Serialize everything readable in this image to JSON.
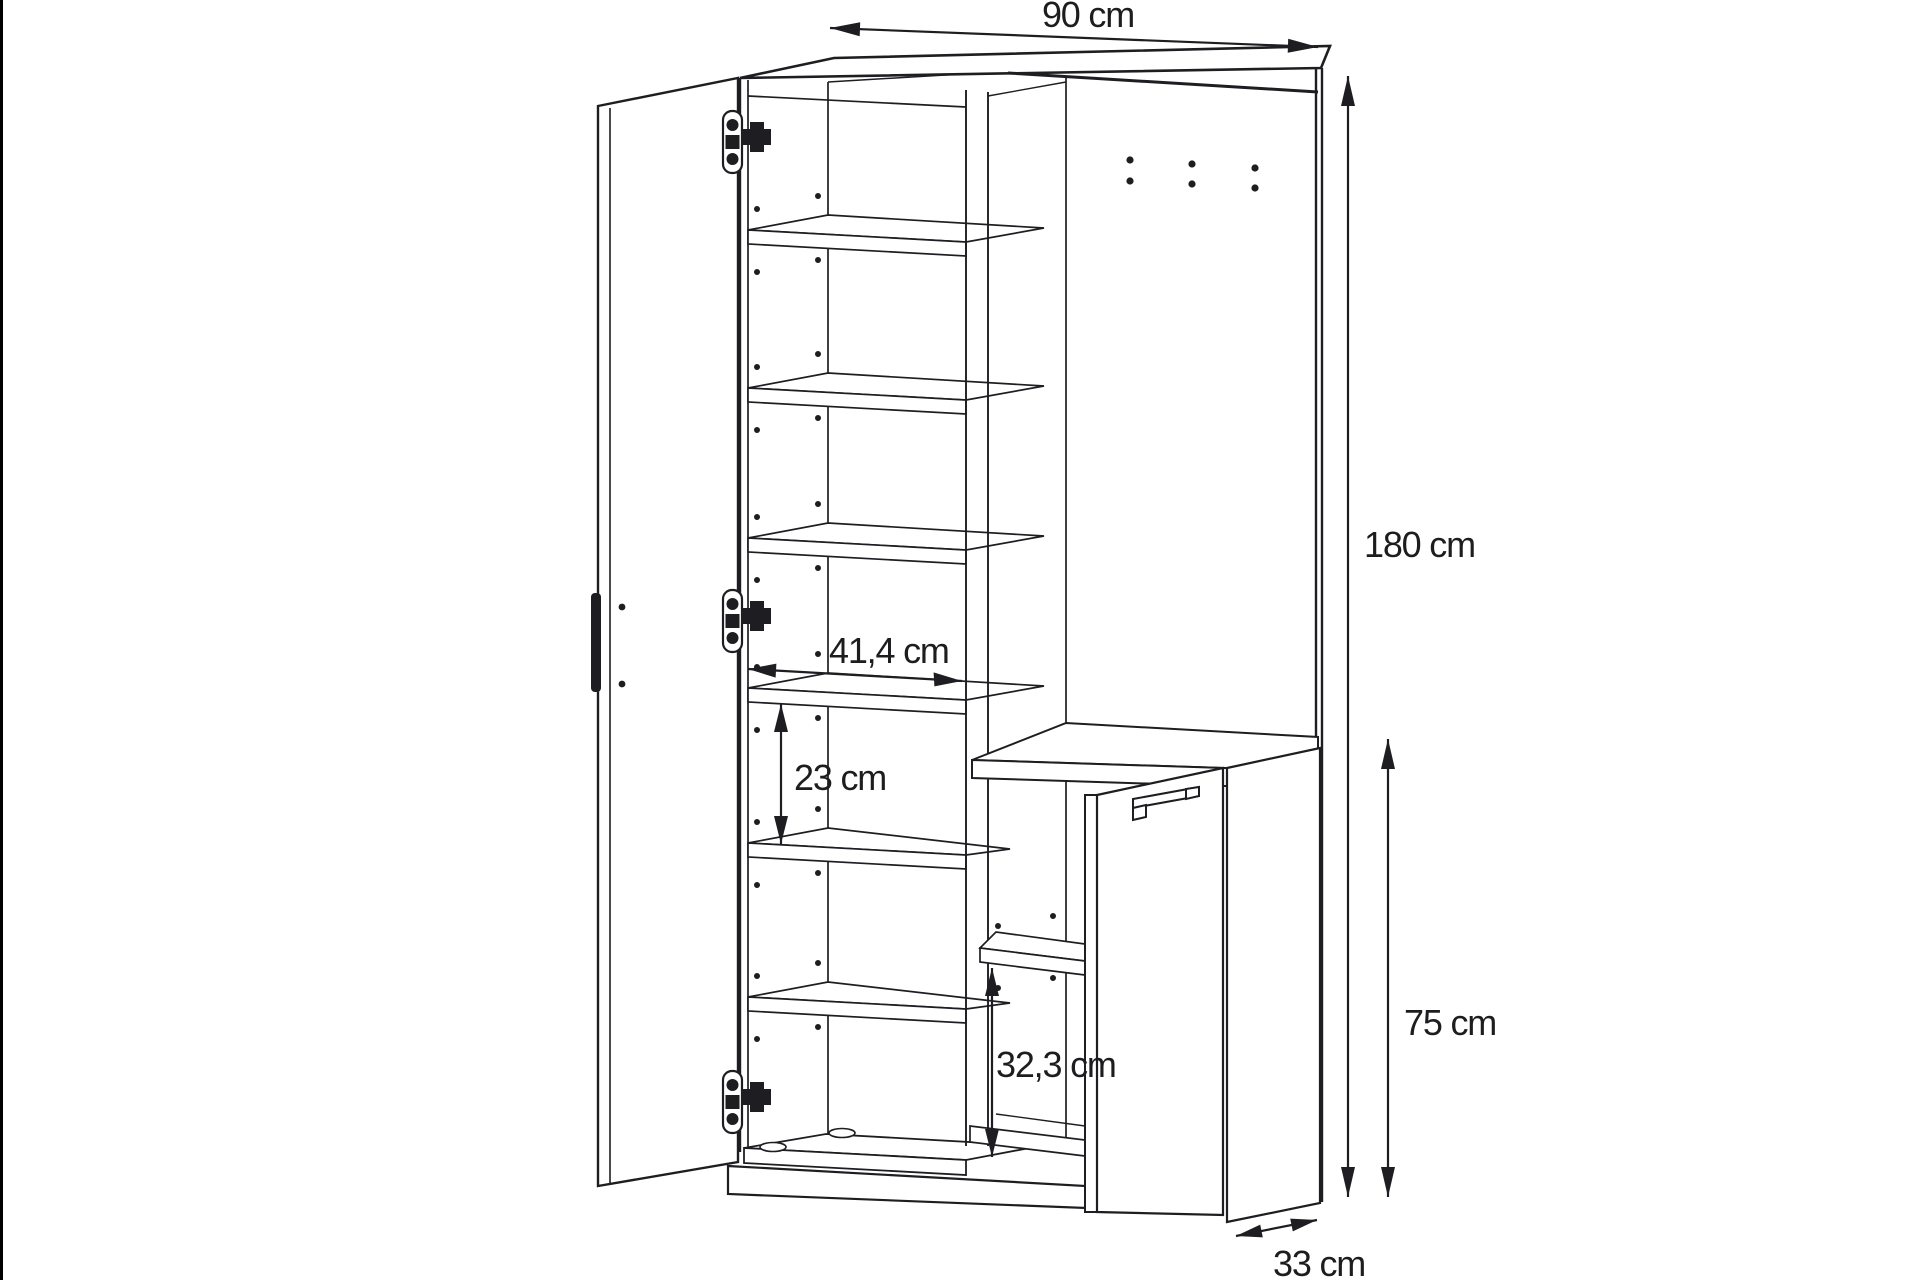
{
  "page": {
    "background": "#ffffff",
    "left_border_color": "#000000"
  },
  "drawing": {
    "type": "furniture-dimension-diagram",
    "line_color": "#1e1e22",
    "labels": {
      "width_total": "90 cm",
      "height_total": "180 cm",
      "height_lower_section": "75 cm",
      "inner_shelf_width": "41,4 cm",
      "shelf_gap_height": "23 cm",
      "lower_compartment_height": "32,3 cm",
      "depth": "33 cm"
    }
  }
}
